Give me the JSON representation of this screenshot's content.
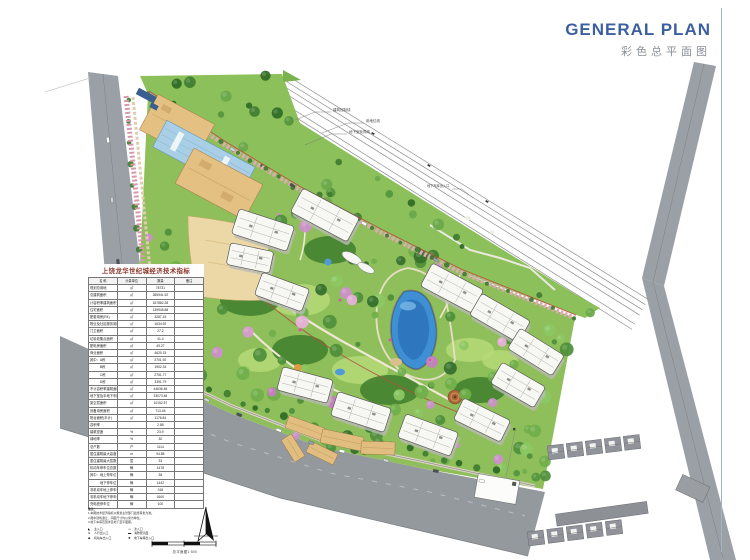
{
  "header": {
    "title_en": "GENERAL PLAN",
    "title_cn": "彩色总平面图"
  },
  "annotations": {
    "control_line": "建筑控制线",
    "red_line": "用地红线",
    "basement_line": "地下室轮廓线",
    "garage_entry": "地下车库出入口"
  },
  "table": {
    "title": "上饶龙华世纪城经济技术指标",
    "columns": [
      "名  称",
      "计量单位",
      "数量",
      "备注"
    ],
    "rows": [
      {
        "name": "规划总用地",
        "unit": "㎡",
        "value": "78731",
        "note": ""
      },
      {
        "name": "总建筑面积",
        "unit": "㎡",
        "value": "285941.92",
        "note": ""
      },
      {
        "name": "计容积率建筑面积",
        "unit": "㎡",
        "value": "167882.28",
        "note": ""
      },
      {
        "name": "住宅面积",
        "unit": "㎡",
        "value": "139945.88",
        "note": ""
      },
      {
        "name": "配套用房(R4)",
        "unit": "㎡",
        "value": "3287.15",
        "note": ""
      },
      {
        "name": "物业及社区服务用房(5‰)",
        "unit": "㎡",
        "value": "1634.92",
        "note": ""
      },
      {
        "name": "门卫面积",
        "unit": "㎡",
        "value": "27.2",
        "note": ""
      },
      {
        "name": "垃圾收集点面积",
        "unit": "㎡",
        "value": "41.4",
        "note": ""
      },
      {
        "name": "配电房面积",
        "unit": "㎡",
        "value": "49.27",
        "note": ""
      },
      {
        "name": "商业面积",
        "unit": "㎡",
        "value": "4620.15",
        "note": ""
      },
      {
        "name": "其中：A栋",
        "unit": "㎡",
        "value": "2701.92",
        "note": ""
      },
      {
        "name": "　　　B栋",
        "unit": "㎡",
        "value": "1902.34",
        "note": ""
      },
      {
        "name": "　　　C栋",
        "unit": "㎡",
        "value": "2751.77",
        "note": ""
      },
      {
        "name": "　　　D栋",
        "unit": "㎡",
        "value": "3391.79",
        "note": ""
      },
      {
        "name": "不计容积率建筑面积",
        "unit": "㎡",
        "value": "44636.48",
        "note": ""
      },
      {
        "name": "地下室及半地下车库",
        "unit": "㎡",
        "value": "33073.48",
        "note": ""
      },
      {
        "name": "架空层面积",
        "unit": "㎡",
        "value": "10152.57",
        "note": ""
      },
      {
        "name": "设备用房面积",
        "unit": "㎡",
        "value": "713.45",
        "note": ""
      },
      {
        "name": "阳台面积(半计)",
        "unit": "㎡",
        "value": "1176.84",
        "note": ""
      },
      {
        "name": "容积率",
        "unit": "",
        "value": "2.88",
        "note": ""
      },
      {
        "name": "建筑密度",
        "unit": "%",
        "value": "23.9",
        "note": ""
      },
      {
        "name": "绿地率",
        "unit": "%",
        "value": "30",
        "note": ""
      },
      {
        "name": "总户数",
        "unit": "户",
        "value": "1114",
        "note": ""
      },
      {
        "name": "居住建筑最大高度",
        "unit": "m",
        "value": "94.85",
        "note": ""
      },
      {
        "name": "居住建筑最大层数",
        "unit": "层",
        "value": "33",
        "note": ""
      },
      {
        "name": "机动车停车位总数",
        "unit": "辆",
        "value": "1478",
        "note": ""
      },
      {
        "name": "其中：地上停车位",
        "unit": "辆",
        "value": "36",
        "note": ""
      },
      {
        "name": "　　　地下停车位",
        "unit": "辆",
        "value": "1442",
        "note": ""
      },
      {
        "name": "非机动车地上停车位",
        "unit": "辆",
        "value": "318",
        "note": ""
      },
      {
        "name": "非机动车地下停车位",
        "unit": "辆",
        "value": "1600",
        "note": ""
      },
      {
        "name": "充电桩停车位",
        "unit": "辆",
        "value": "100",
        "note": ""
      }
    ]
  },
  "notes": {
    "label": "备注：",
    "lines": [
      "1.本图技术经济指标以规划主管部门最终审批为准。",
      "2.图中建筑退让、间距尺寸均以米为单位。",
      "3.地下车库范围详见地下室平面图。"
    ]
  },
  "legend": {
    "items": [
      {
        "symbol": "◣",
        "label": "主入口"
      },
      {
        "symbol": "◅",
        "label": "次入口"
      },
      {
        "symbol": "➤",
        "label": "人行出入口"
      },
      {
        "symbol": "▬",
        "label": "消防登高面"
      },
      {
        "symbol": "◆",
        "label": "机动车出入口"
      },
      {
        "symbol": "✚",
        "label": "地下车库出入口"
      }
    ]
  },
  "scale": {
    "caption": "总平面图1:500"
  },
  "colors": {
    "accent_blue": "#3c5fa0",
    "subtitle_gray": "#8a9097",
    "table_title_red": "#8a3428",
    "site_green": "#6fae49",
    "pond_blue": "#3f8fd4",
    "road_gray": "#94999e",
    "commercial_tan": "#e4c083",
    "glass_blue": "#a9cfe6",
    "boulevard_pink": "#e2a8b8"
  }
}
